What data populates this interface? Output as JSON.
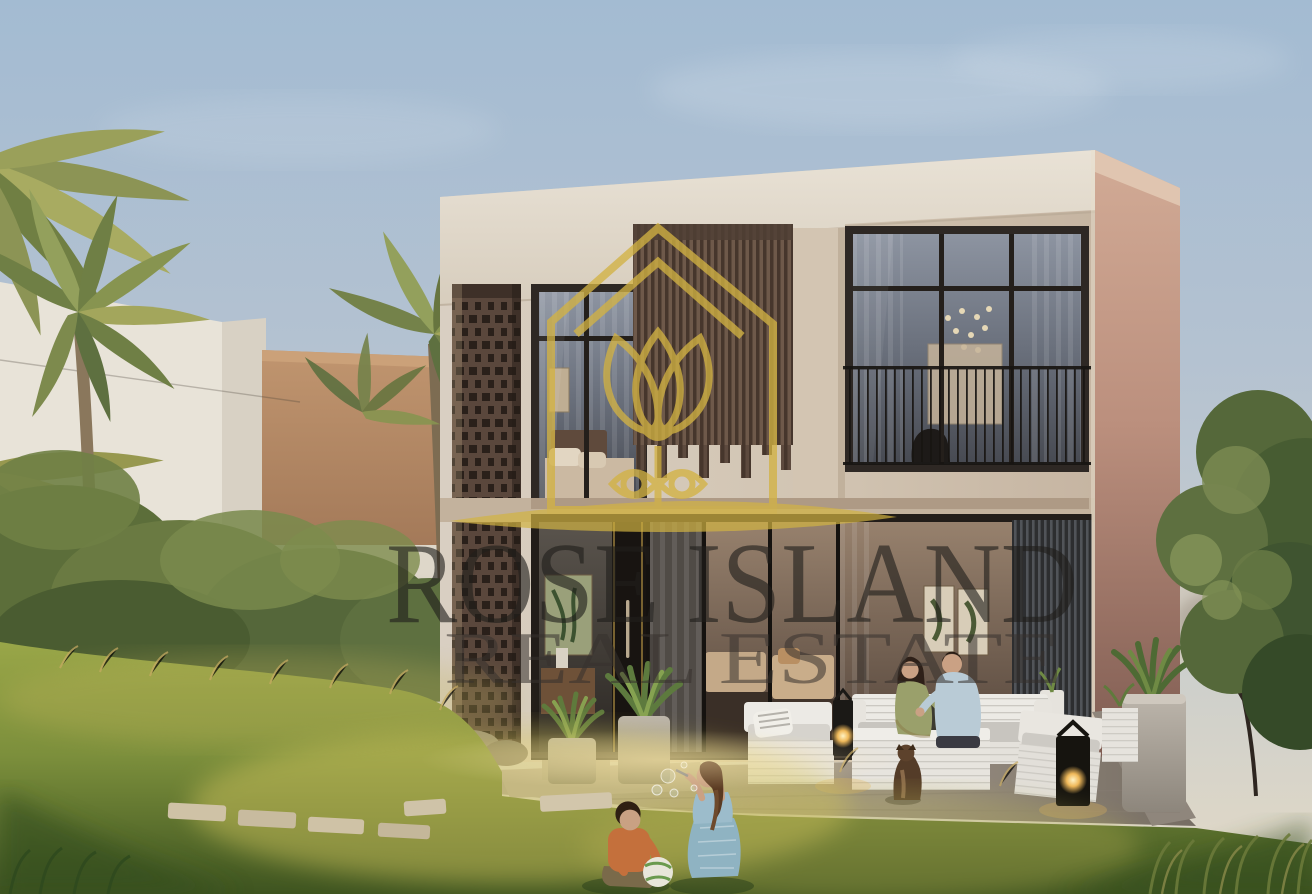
{
  "watermark": {
    "line1": "ROSE ISLAND",
    "line2": "REAL ESTATE",
    "logo": "rose-island-house-tulip-logo",
    "gold": "#d2b243",
    "line1_color": "rgba(32,30,27,0.62)",
    "line2_color": "rgba(54,50,46,0.55)"
  },
  "scene_palette": {
    "sky_top": "#a3bbd2",
    "sky_horizon": "#e4dac6",
    "facade_cream": "#d2c5b3",
    "side_wall_pink": "#bb8f7d",
    "wood_slat_brown": "#5d4a3e",
    "window_glass": "#6a707c",
    "lattice_brick": "#5a473c",
    "patio_concrete": "#9b9186",
    "outdoor_furniture_white": "#eceae5",
    "lawn_sunlit": "#c8bd5e",
    "lawn_shadow": "#3e5420",
    "boy_shirt_orange": "#c4703c",
    "girl_dress_blue": "#8fb3c2"
  }
}
